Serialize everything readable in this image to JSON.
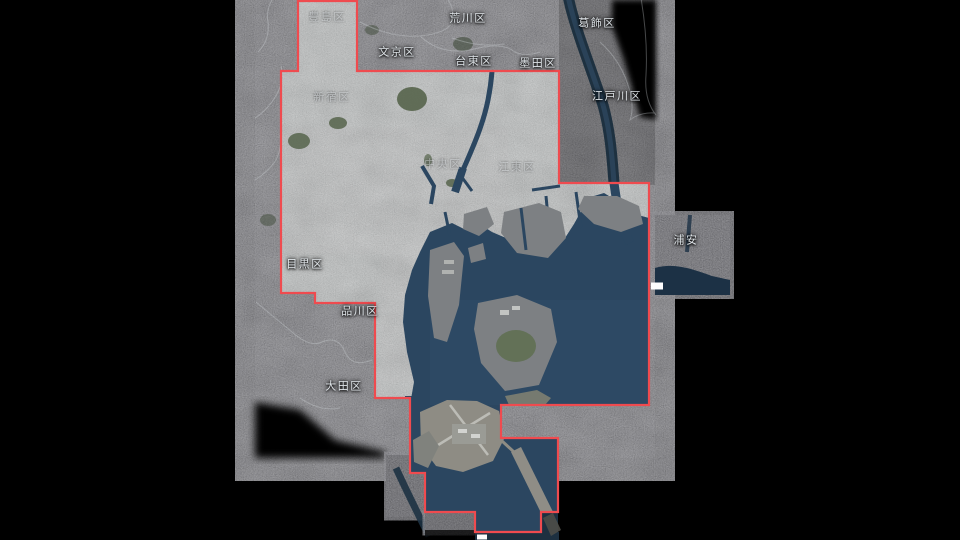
{
  "map": {
    "type": "satellite-map-tokyo-bay",
    "labels": [
      {
        "id": "toshima",
        "text": "豊島区",
        "x": 327,
        "y": 18,
        "style": "faint"
      },
      {
        "id": "arakawa",
        "text": "荒川区",
        "x": 468,
        "y": 19,
        "style": "bright"
      },
      {
        "id": "katsushika",
        "text": "葛飾区",
        "x": 597,
        "y": 24,
        "style": "bright"
      },
      {
        "id": "bunkyo",
        "text": "文京区",
        "x": 397,
        "y": 53,
        "style": "bright"
      },
      {
        "id": "taito",
        "text": "台東区",
        "x": 474,
        "y": 62,
        "style": "bright"
      },
      {
        "id": "sumida",
        "text": "墨田区",
        "x": 538,
        "y": 64,
        "style": "bright"
      },
      {
        "id": "edogawa",
        "text": "江戸川区",
        "x": 617,
        "y": 97,
        "style": "bright"
      },
      {
        "id": "shinjuku",
        "text": "新宿区",
        "x": 332,
        "y": 98,
        "style": "faint"
      },
      {
        "id": "chuo",
        "text": "中央区",
        "x": 443,
        "y": 165,
        "style": "faint"
      },
      {
        "id": "koto",
        "text": "江東区",
        "x": 517,
        "y": 168,
        "style": "faint"
      },
      {
        "id": "meguro",
        "text": "目黒区",
        "x": 305,
        "y": 265,
        "style": "bright"
      },
      {
        "id": "shinagawa",
        "text": "品川区",
        "x": 360,
        "y": 312,
        "style": "bright"
      },
      {
        "id": "ota",
        "text": "大田区",
        "x": 344,
        "y": 387,
        "style": "bright"
      },
      {
        "id": "urayasu",
        "text": "浦安",
        "x": 686,
        "y": 241,
        "style": "bright"
      }
    ],
    "artifacts": [
      {
        "id": "patch-right",
        "x": 657,
        "y": 286
      },
      {
        "id": "patch-bottom",
        "x": 482,
        "y": 537
      }
    ],
    "colors": {
      "background": "#000000",
      "boundary_red": "#ef4b4f",
      "bay_water": "#2b4660",
      "dim_water": "#1e3140",
      "label_text": "#eef3f7"
    }
  }
}
